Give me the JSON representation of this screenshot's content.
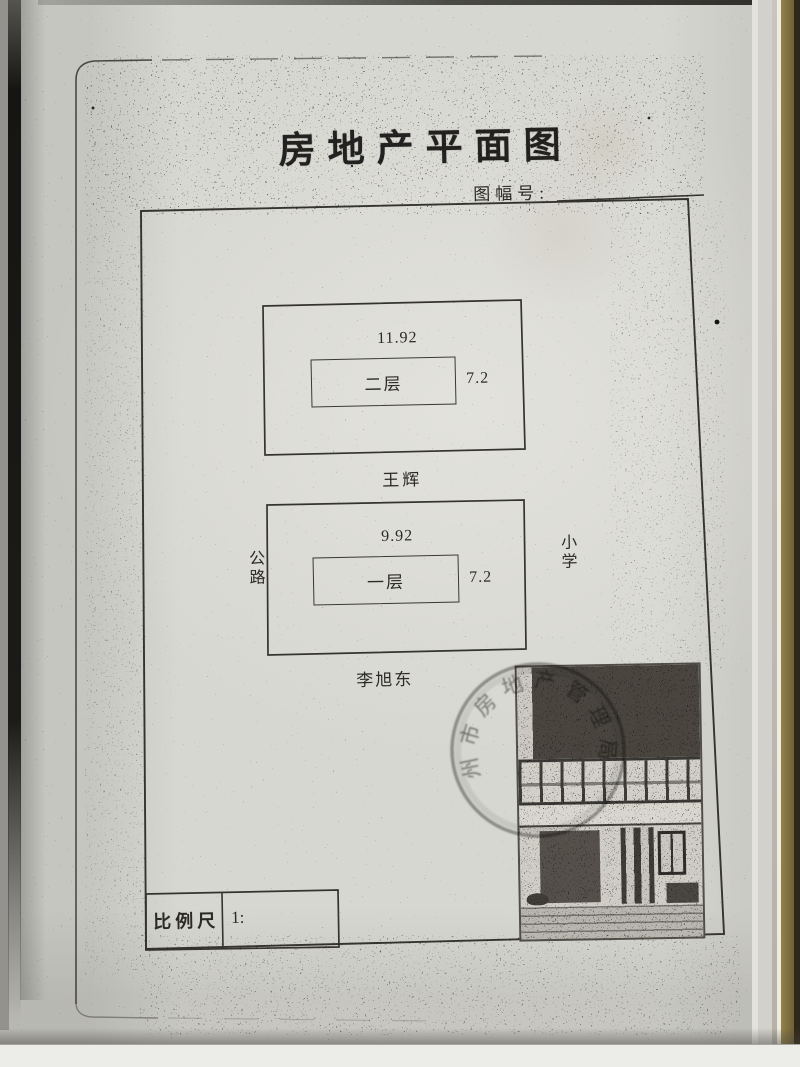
{
  "document": {
    "title": "房地产平面图",
    "sheet_number_label": "图幅号:",
    "sheet_number_value": ""
  },
  "plan": {
    "upper_building": {
      "length": "11.92",
      "depth": "7.2",
      "floor": "二层",
      "adjacent_owner": "王辉"
    },
    "lower_building": {
      "length": "9.92",
      "depth": "7.2",
      "floor": "一层",
      "adjacent_owner": "李旭东"
    },
    "left_adjacency": "公路",
    "right_adjacency": "小学"
  },
  "scale": {
    "label": "比例尺",
    "ratio_prefix": "1:",
    "ratio_value": ""
  },
  "stamp": {
    "arc_text": "州市房地产管理局"
  },
  "colors": {
    "paper": "#d7d7d2",
    "ink": "#35332e",
    "book_edge": "#8a7a46"
  }
}
